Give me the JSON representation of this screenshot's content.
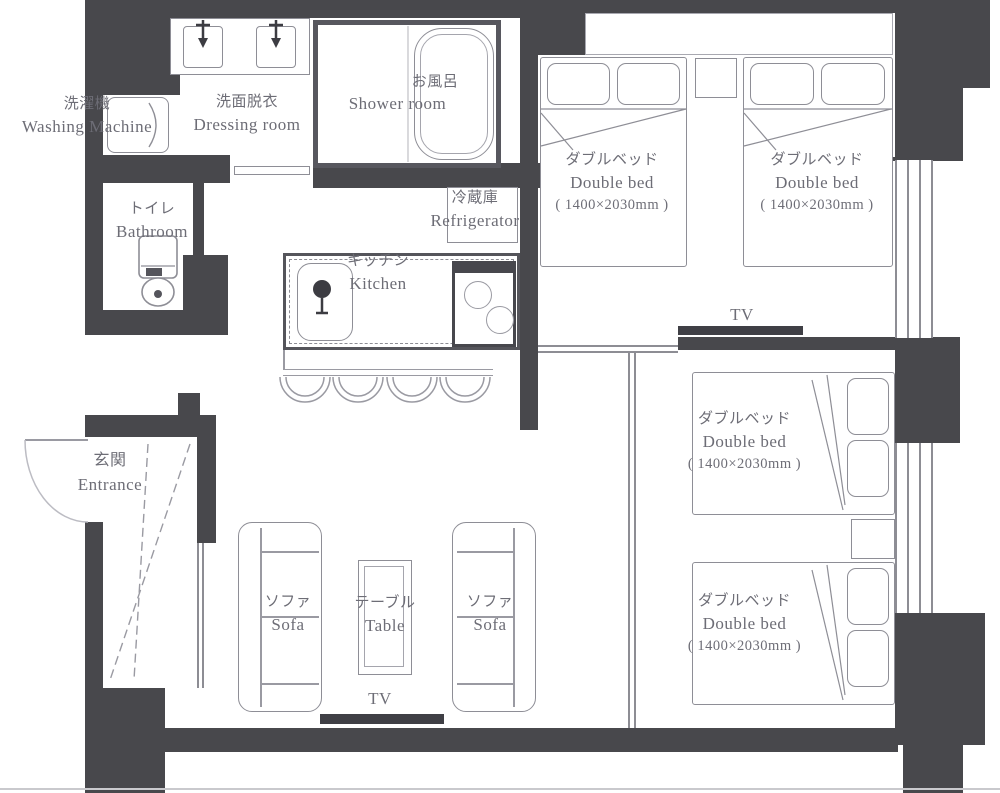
{
  "plan": {
    "rooms": {
      "washing_machine": {
        "jp": "洗濯機",
        "en": "Washing Machine"
      },
      "dressing_room": {
        "jp": "洗面脱衣",
        "en": "Dressing room"
      },
      "shower_room": {
        "jp": "お風呂",
        "en": "Shower room"
      },
      "bathroom": {
        "jp": "トイレ",
        "en": "Bathroom"
      },
      "refrigerator": {
        "jp": "冷蔵庫",
        "en": "Refrigerator"
      },
      "kitchen": {
        "jp": "キッチン",
        "en": "Kitchen"
      },
      "entrance": {
        "jp": "玄関",
        "en": "Entrance"
      }
    },
    "living": {
      "sofa_left": {
        "jp": "ソファ",
        "en": "Sofa"
      },
      "sofa_right": {
        "jp": "ソファ",
        "en": "Sofa"
      },
      "table": {
        "jp": "テーブル",
        "en": "Table"
      },
      "tv": "TV"
    },
    "bedroom_upper": {
      "tv": "TV",
      "beds": [
        {
          "jp": "ダブルベッド",
          "en": "Double bed",
          "size": "( 1400×2030mm )"
        },
        {
          "jp": "ダブルベッド",
          "en": "Double bed",
          "size": "( 1400×2030mm )"
        }
      ]
    },
    "bedroom_lower": {
      "beds": [
        {
          "jp": "ダブルベッド",
          "en": "Double bed",
          "size": "( 1400×2030mm )"
        },
        {
          "jp": "ダブルベッド",
          "en": "Double bed",
          "size": "( 1400×2030mm )"
        }
      ]
    },
    "colors": {
      "wall": "#48484c",
      "furniture_line": "#8e8e96",
      "text": "#6d6d76"
    }
  }
}
